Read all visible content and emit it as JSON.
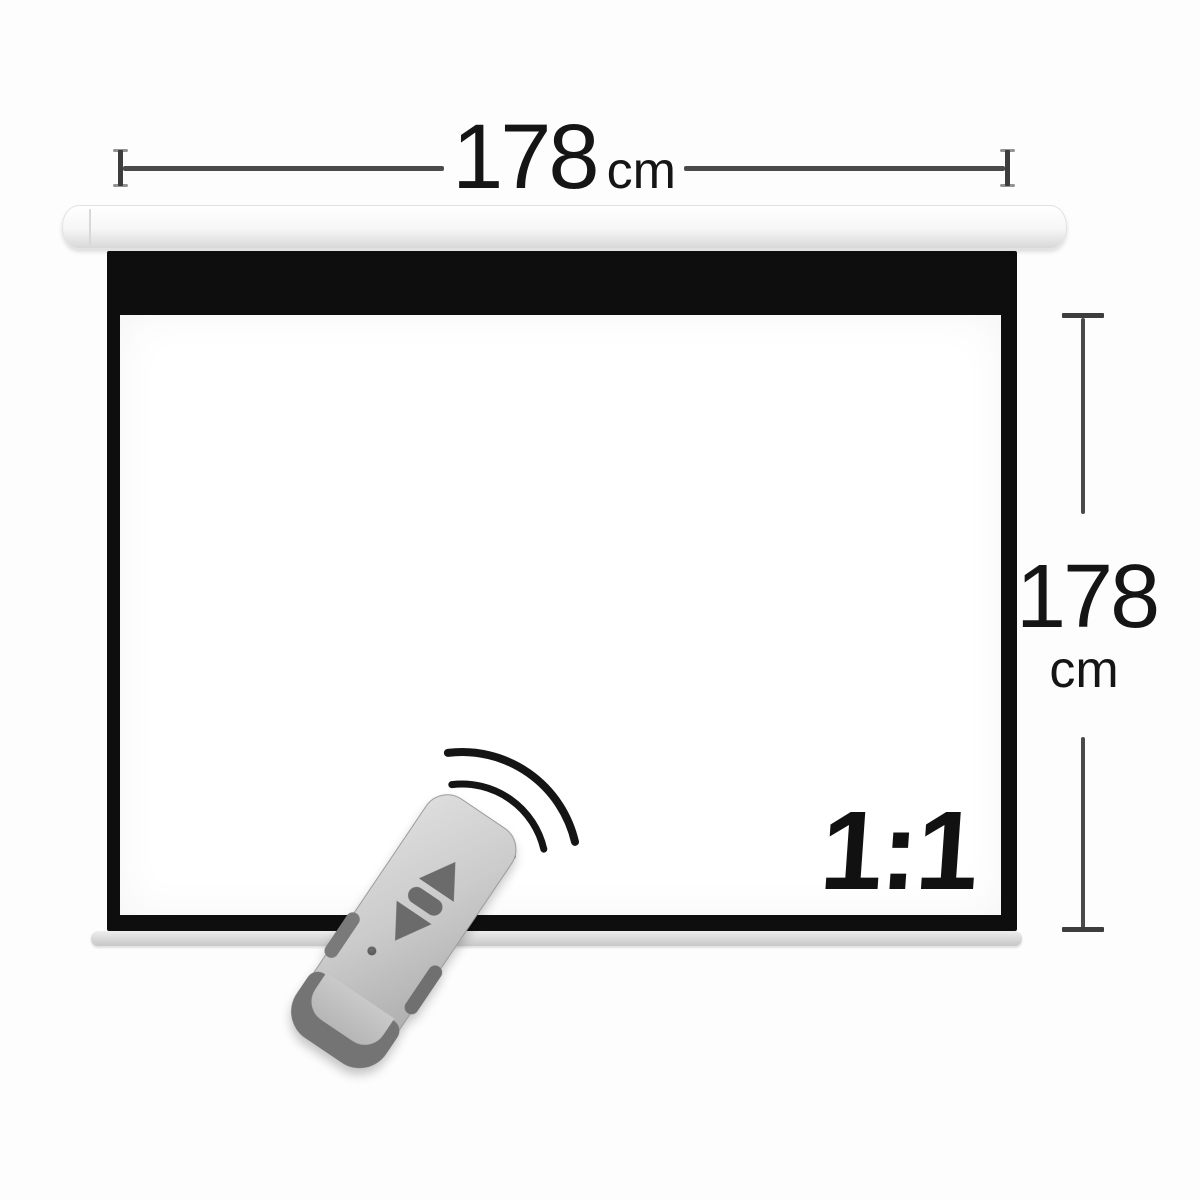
{
  "dimensions": {
    "width": {
      "value": "178",
      "unit": "cm"
    },
    "height": {
      "value": "178",
      "unit": "cm"
    }
  },
  "screen": {
    "aspect_ratio_label": "1:1"
  },
  "icons": {
    "remote": "remote-control-icon",
    "signal": "signal-waves-icon"
  },
  "colors": {
    "background": "#fdfdfd",
    "frame_black": "#0e0e0e",
    "housing_white": "#f6f6f6",
    "weight_bar_gray": "#d8d8d8",
    "dimension_line": "#4a4a4a",
    "label_text": "#151515",
    "remote_body_gray": "#c9c9c9",
    "remote_dark_gray": "#6b6b6b"
  }
}
